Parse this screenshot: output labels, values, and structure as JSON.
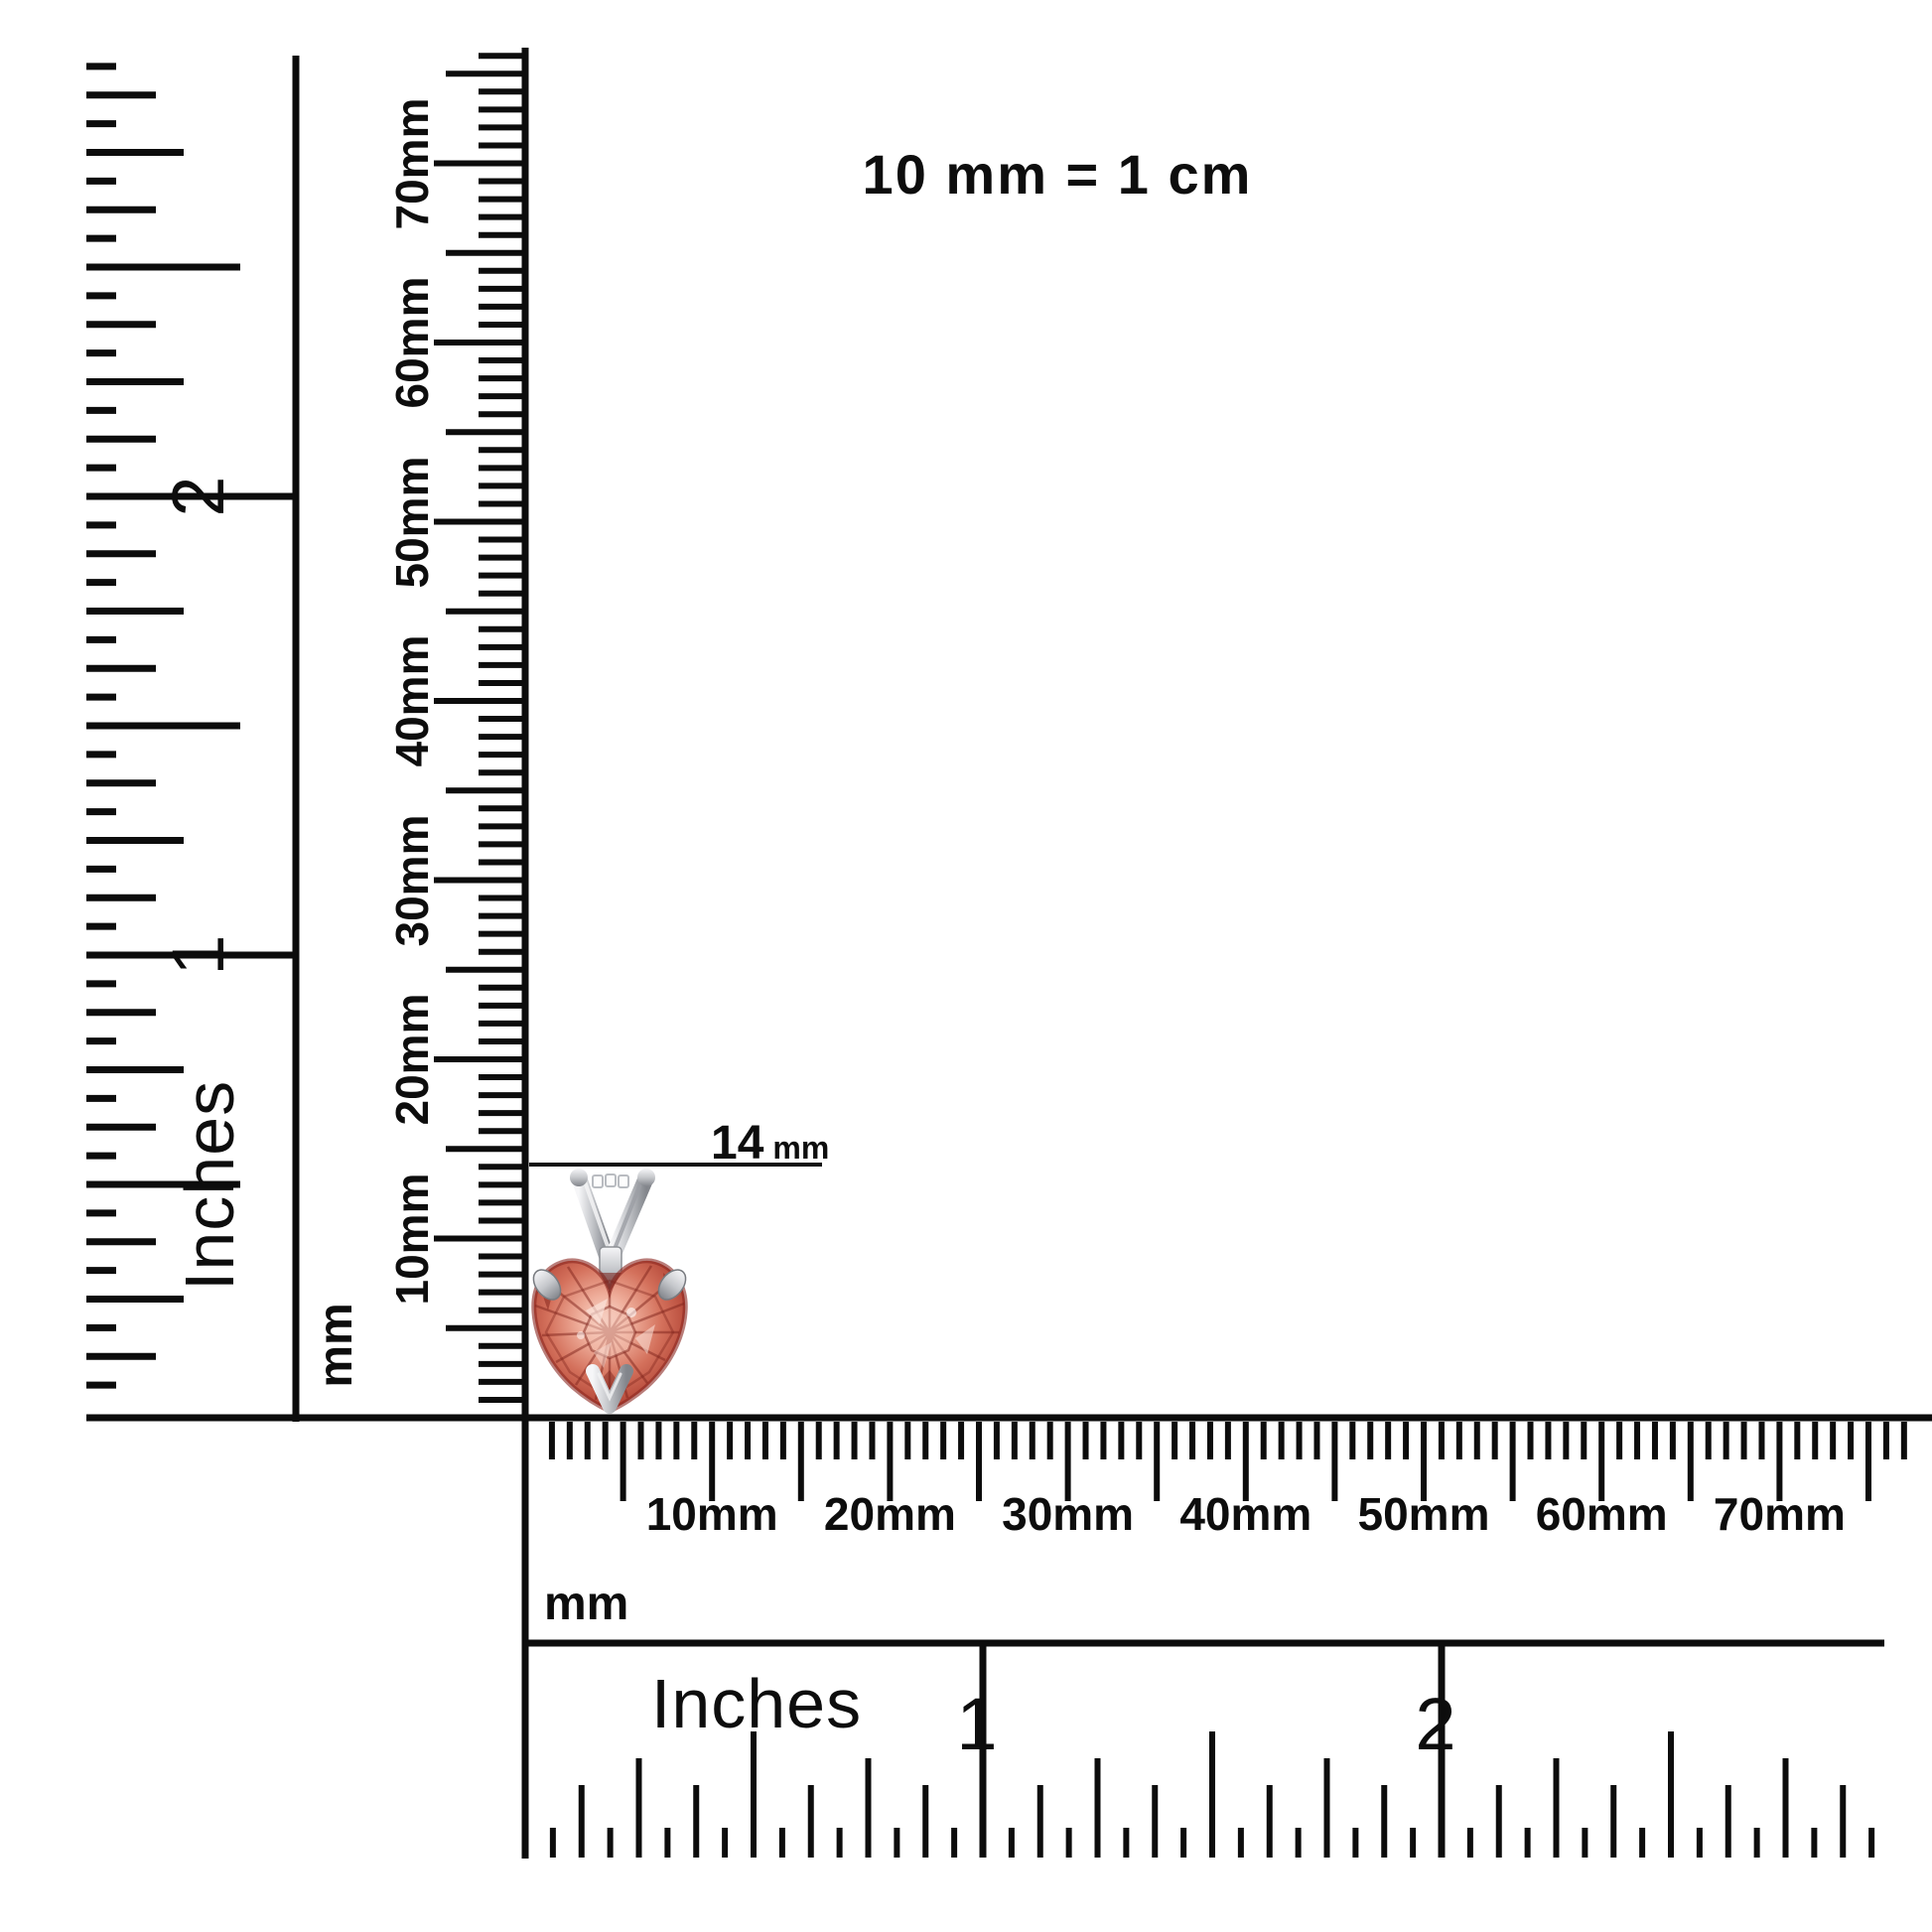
{
  "note": {
    "text": "10 mm = 1 cm"
  },
  "measurement": {
    "value": "14",
    "unit": "mm",
    "label": "14 mm"
  },
  "product": {
    "name": "heart-cut red gemstone solitaire pendant with V-bail",
    "stone_outer": "#8e2a20",
    "stone_deep": "#b24435",
    "stone_mid": "#d4715c",
    "stone_light": "#efae9b",
    "stone_highlight": "#f9dcd2",
    "metal_light": "#f6f6f8",
    "metal_mid": "#c6c8cc",
    "metal_dark": "#82858b"
  },
  "rulers": {
    "line_color": "#0c0c0c",
    "left_inches": {
      "title": "Inches",
      "numerals": [
        "1",
        "2"
      ]
    },
    "vertical_mm": {
      "title": "mm",
      "labels": [
        "10mm",
        "20mm",
        "30mm",
        "40mm",
        "50mm",
        "60mm",
        "70mm"
      ]
    },
    "bottom_mm": {
      "title": "mm",
      "labels": [
        "10mm",
        "20mm",
        "30mm",
        "40mm",
        "50mm",
        "60mm",
        "70mm"
      ]
    },
    "bottom_inches": {
      "title": "Inches",
      "numerals": [
        "1",
        "2"
      ]
    }
  }
}
